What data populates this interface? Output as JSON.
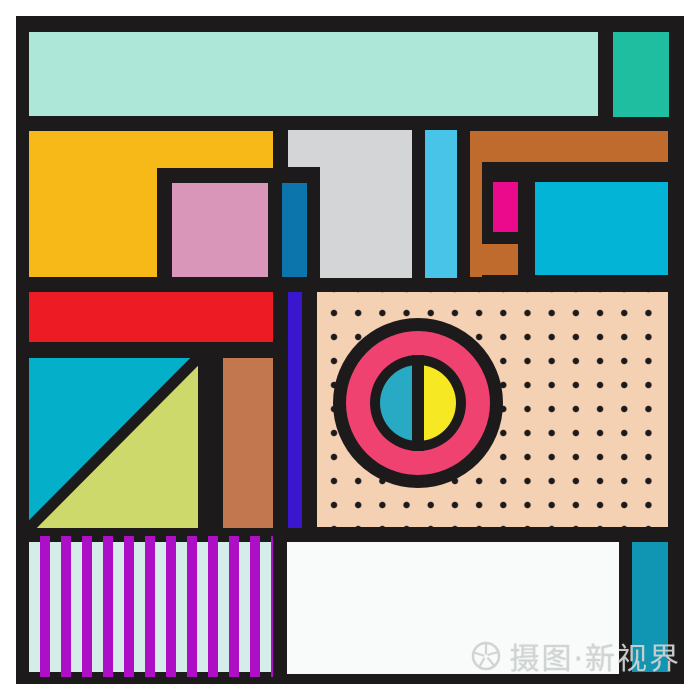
{
  "artwork": {
    "description": "abstract-geometric-memphis-composition",
    "canvas_color": "#ffffff",
    "frame_color": "#1d1a1b",
    "frame": {
      "x": 16,
      "y": 16,
      "w": 668,
      "h": 668
    },
    "palette": {
      "black": "#1d1a1b",
      "mint": "#ace7d7",
      "green": "#1fbea1",
      "yellow": "#f6b917",
      "pink": "#d996b8",
      "gray": "#d3d5d7",
      "blue": "#0b75ac",
      "sky_blue": "#48c4e8",
      "brown": "#c06b2e",
      "magenta": "#eb0a8c",
      "cyan": "#04b4d6",
      "red": "#ed1b24",
      "violet": "#3a16cf",
      "peach": "#f4d1b2",
      "rose": "#ef4271",
      "teal_cyan": "#28a9c4",
      "bright_yellow": "#f6e822",
      "lime": "#cdd96b",
      "salmon": "#c3774f",
      "stripe_magenta": "#ad0fc7",
      "stripe_mint": "#d5ede8",
      "off_white": "#f8fbfa",
      "teal": "#1095b2"
    },
    "shapes": [
      {
        "name": "mint-bar",
        "type": "rect",
        "x": 29,
        "y": 32,
        "w": 569,
        "h": 84,
        "color": "#ace7d7"
      },
      {
        "name": "green-block",
        "type": "rect",
        "x": 613,
        "y": 32,
        "w": 56,
        "h": 85,
        "color": "#1fbea1"
      },
      {
        "name": "yellow-block-top",
        "type": "rect",
        "x": 29,
        "y": 131,
        "w": 244,
        "h": 37,
        "color": "#f6b917"
      },
      {
        "name": "yellow-block-left",
        "type": "rect",
        "x": 29,
        "y": 131,
        "w": 128,
        "h": 146,
        "color": "#f6b917"
      },
      {
        "name": "pink-square",
        "type": "rect",
        "x": 172,
        "y": 183,
        "w": 96,
        "h": 94,
        "color": "#d996b8"
      },
      {
        "name": "gray-block-top",
        "type": "rect",
        "x": 288,
        "y": 130,
        "w": 124,
        "h": 37,
        "color": "#d3d5d7"
      },
      {
        "name": "gray-block-main",
        "type": "rect",
        "x": 320,
        "y": 130,
        "w": 92,
        "h": 148,
        "color": "#d3d5d7"
      },
      {
        "name": "blue-bar",
        "type": "rect",
        "x": 282,
        "y": 183,
        "w": 25,
        "h": 94,
        "color": "#0b75ac"
      },
      {
        "name": "skyblue-bar",
        "type": "rect",
        "x": 425,
        "y": 130,
        "w": 32,
        "h": 148,
        "color": "#48c4e8"
      },
      {
        "name": "brown-top-bar",
        "type": "rect",
        "x": 470,
        "y": 131,
        "w": 198,
        "h": 31,
        "color": "#c06b2e"
      },
      {
        "name": "brown-left-strip",
        "type": "rect",
        "x": 470,
        "y": 131,
        "w": 12,
        "h": 146,
        "color": "#c06b2e"
      },
      {
        "name": "brown-foot",
        "type": "rect",
        "x": 470,
        "y": 244,
        "w": 48,
        "h": 31,
        "color": "#c06b2e"
      },
      {
        "name": "magenta-rect",
        "type": "rect",
        "x": 493,
        "y": 182,
        "w": 25,
        "h": 50,
        "color": "#eb0a8c"
      },
      {
        "name": "cyan-rect",
        "type": "rect",
        "x": 535,
        "y": 182,
        "w": 133,
        "h": 93,
        "color": "#04b4d6"
      },
      {
        "name": "red-bar",
        "type": "rect",
        "x": 29,
        "y": 292,
        "w": 244,
        "h": 50,
        "color": "#ed1b24"
      },
      {
        "name": "violet-bar",
        "type": "rect",
        "x": 288,
        "y": 292,
        "w": 14,
        "h": 236,
        "color": "#3a16cf"
      },
      {
        "name": "dotted-panel",
        "type": "dots",
        "x": 317,
        "y": 292,
        "w": 351,
        "h": 235,
        "color": "#f4d1b2",
        "dot": "#1d1a1b"
      },
      {
        "name": "target-circle",
        "type": "target",
        "x": 333,
        "y": 318,
        "w": 170,
        "h": 170,
        "outer": "#1d1a1b",
        "ring": "#ef4271",
        "left": "#28a9c4",
        "right": "#f6e822"
      },
      {
        "name": "diagonal-square",
        "type": "diag",
        "x": 29,
        "y": 358,
        "w": 169,
        "h": 170,
        "color": "#04b0c9",
        "color2": "#cdd96b",
        "line": "#1d1a1b"
      },
      {
        "name": "salmon-rect",
        "type": "rect",
        "x": 223,
        "y": 358,
        "w": 50,
        "h": 170,
        "color": "#c3774f"
      },
      {
        "name": "stripe-panel-bg",
        "type": "rect",
        "x": 29,
        "y": 542,
        "w": 244,
        "h": 130,
        "color": "#d5ede8"
      },
      {
        "name": "stripe-panel-stripes",
        "type": "stripes",
        "x": 29,
        "y": 536,
        "w": 244,
        "h": 141,
        "stripe": "#ad0fc7"
      },
      {
        "name": "white-panel",
        "type": "rect",
        "x": 287,
        "y": 542,
        "w": 332,
        "h": 132,
        "color": "#f8fbfa"
      },
      {
        "name": "teal-bar",
        "type": "rect",
        "x": 632,
        "y": 542,
        "w": 36,
        "h": 130,
        "color": "#1095b2"
      }
    ]
  },
  "watermark": {
    "icon": "aperture-icon",
    "text": "摄图·新视界",
    "color": "#ced3d1"
  }
}
